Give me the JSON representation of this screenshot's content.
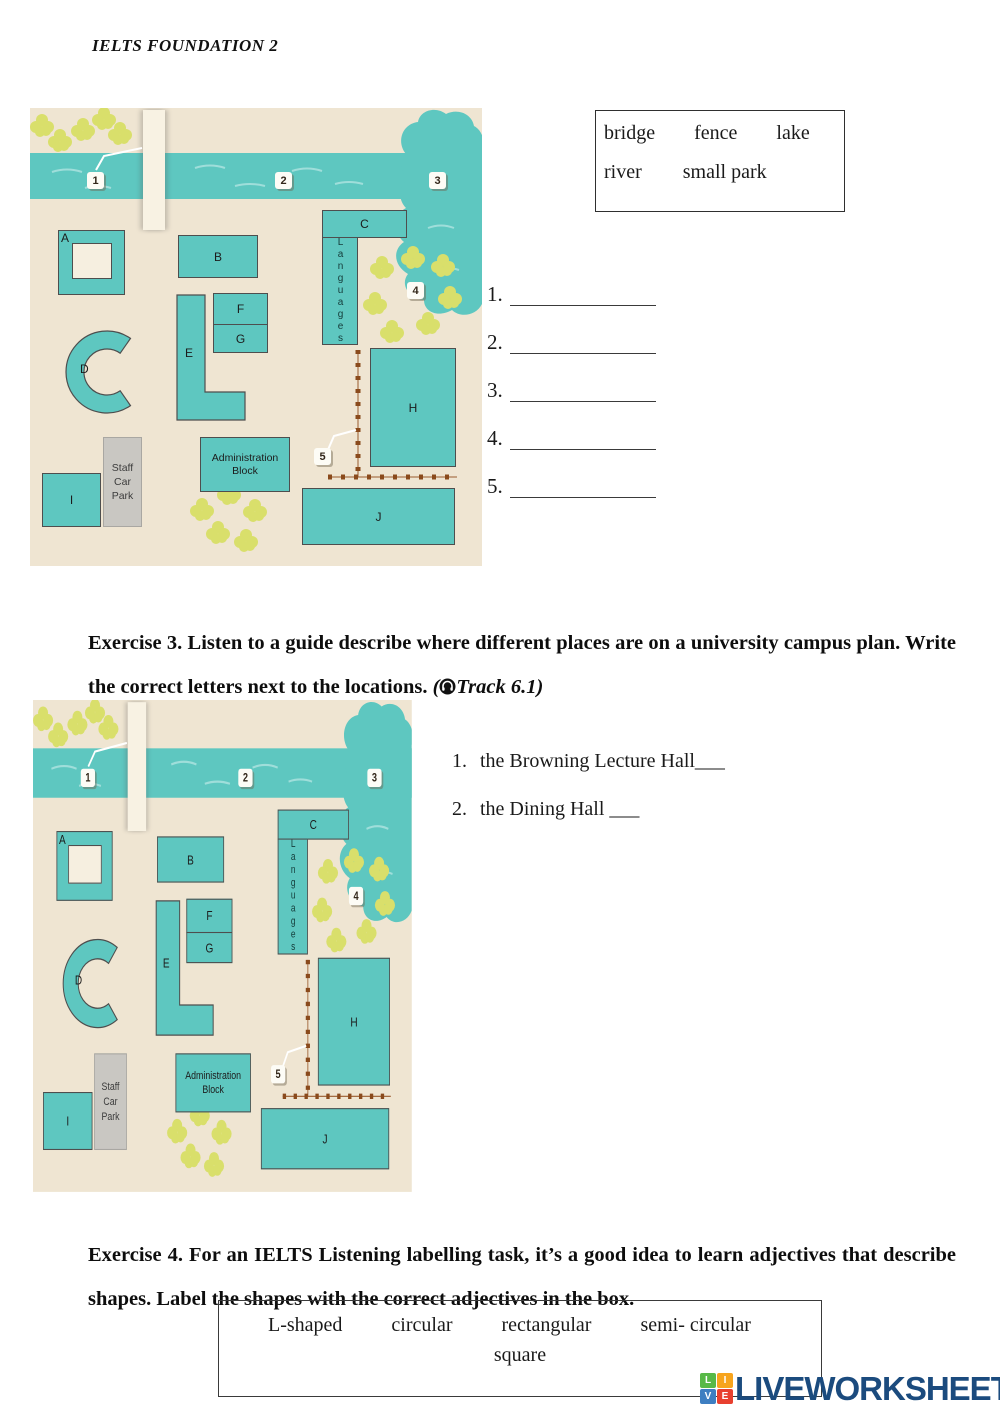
{
  "header": {
    "title": "IELTS FOUNDATION 2"
  },
  "word_box": {
    "row1": [
      "bridge",
      "fence",
      "lake"
    ],
    "row2": [
      "river",
      "small park"
    ]
  },
  "answer_blanks": {
    "items": [
      {
        "num": "1."
      },
      {
        "num": "2."
      },
      {
        "num": "3."
      },
      {
        "num": "4."
      },
      {
        "num": "5."
      }
    ]
  },
  "exercise3": {
    "text": "Exercise 3. Listen to a guide describe where different places are on a university campus plan. Write the correct letters next to the locations. ",
    "track_open": "(",
    "track_label": "Track 6.1)"
  },
  "questions": [
    {
      "num": "1.",
      "text": "the Browning Lecture  Hall___"
    },
    {
      "num": "2.",
      "text": "the Dining Hall ___"
    }
  ],
  "exercise4": {
    "text": "Exercise 4. For an IELTS Listening labelling task, it’s a good idea to learn adjectives that describe shapes. Label the shapes with the correct adjectives in the box."
  },
  "shape_box": {
    "row1": [
      "L-shaped",
      "circular",
      "rectangular",
      "semi- circular"
    ],
    "row2": "square"
  },
  "map": {
    "markers": {
      "m1": "1",
      "m2": "2",
      "m3": "3",
      "m4": "4",
      "m5": "5"
    },
    "buildings": {
      "a": "A",
      "b": "B",
      "c": "C",
      "d": "D",
      "e": "E",
      "f": "F",
      "g": "G",
      "h": "H",
      "i": "I",
      "j": "J"
    },
    "languages": "Languages",
    "admin_line1": "Administration",
    "admin_line2": "Block",
    "staff_line1": "Staff",
    "staff_line2": "Car",
    "staff_line3": "Park"
  },
  "logo": {
    "text": "LIVEWORKSHEETS",
    "tiles": [
      {
        "letter": "L"
      },
      {
        "letter": "I"
      },
      {
        "letter": "V"
      },
      {
        "letter": "E"
      }
    ]
  },
  "colors": {
    "map_teal": "#5EC7C0",
    "map_beige": "#EFE5D2",
    "flower_green": "#D9DF6B",
    "fence_brown": "#8A4A1C",
    "carpark_gray": "#C9C7C2",
    "logo_navy": "#1B4B7E"
  }
}
